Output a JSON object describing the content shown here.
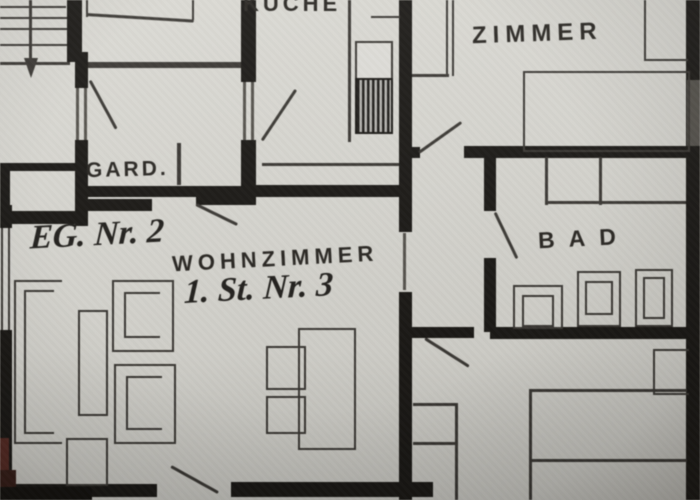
{
  "plan": {
    "labels": {
      "kueche": "KÜCHE",
      "zimmer": "ZIMMER",
      "gard": "GARD.",
      "wohnzimmer": "WOHNZIMMER",
      "bad": "BAD",
      "annotation_eg": "EG. Nr. 2",
      "annotation_st": "1. St. Nr. 3"
    },
    "colors": {
      "paper": "#d5d4ce",
      "paper2": "#c8c7c1",
      "wall": "#1b1915",
      "thin": "#3b3833",
      "mid": "#55524b",
      "ink": "#2a2722",
      "maroon": "#5c2a22"
    }
  }
}
